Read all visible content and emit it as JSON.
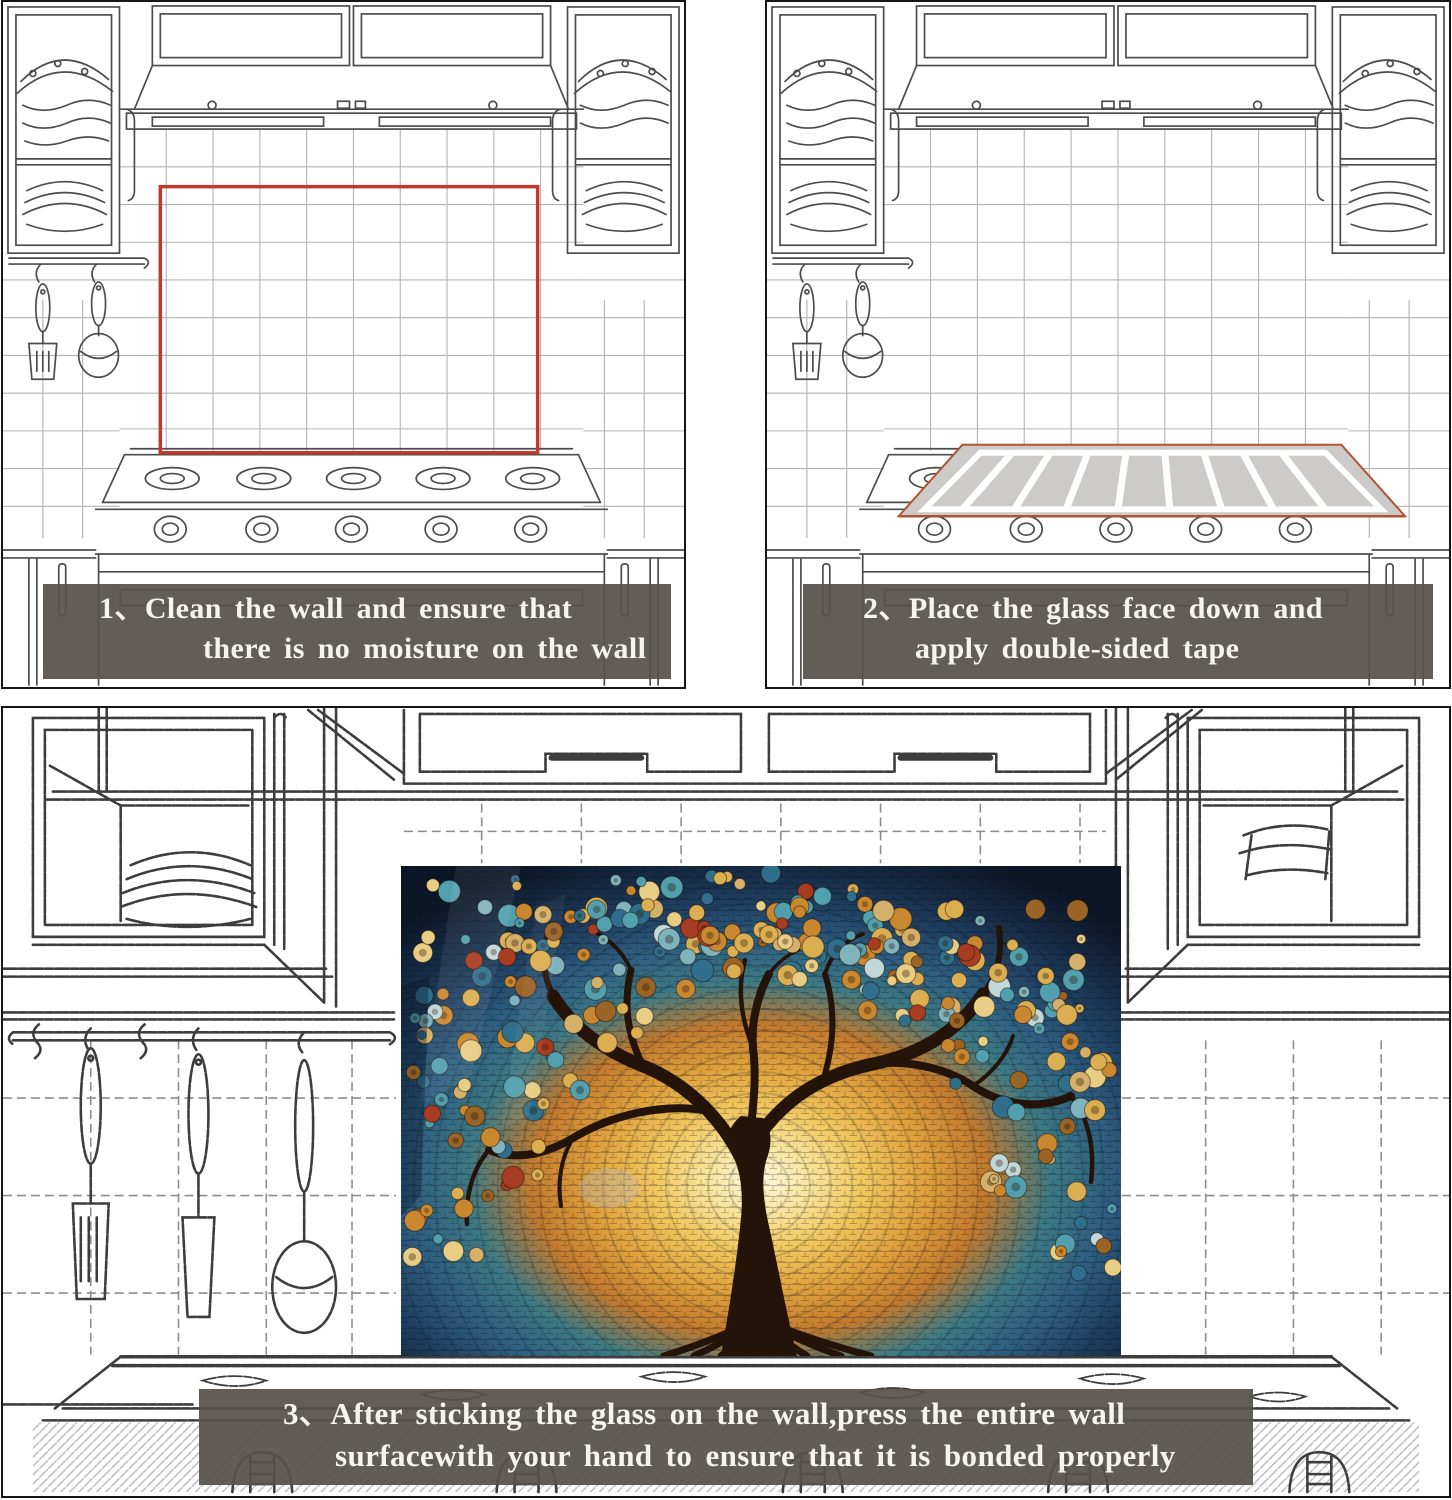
{
  "document": {
    "type": "glass-backsplash installation instructions",
    "language": "en"
  },
  "steps": [
    {
      "number": "1、",
      "line1": "Clean the wall and ensure that",
      "line2": "there is no moisture on the wall"
    },
    {
      "number": "2、",
      "line1": "Place the glass face down and",
      "line2": "apply double-sided tape"
    },
    {
      "number": "3、",
      "line1": "After sticking the glass on the wall,press the entire wall",
      "line2": "surfacewith your hand to ensure that it is  bonded properly"
    }
  ],
  "colors": {
    "marker_red": "#bf3a2d",
    "banner_bg": "rgba(86,82,74,0.93)",
    "banner_text": "#f6f4ef",
    "sketch_line": "#4c4c4c",
    "glass_gray": "#cccbc8",
    "tape_white": "#ffffff"
  },
  "artwork": {
    "subject": "tree of life mosaic glass panel",
    "palette": [
      "#dcae52",
      "#c9882f",
      "#52a0ae",
      "#2f6f8c",
      "#a83c22",
      "#fff8dc",
      "#0c1626"
    ]
  }
}
